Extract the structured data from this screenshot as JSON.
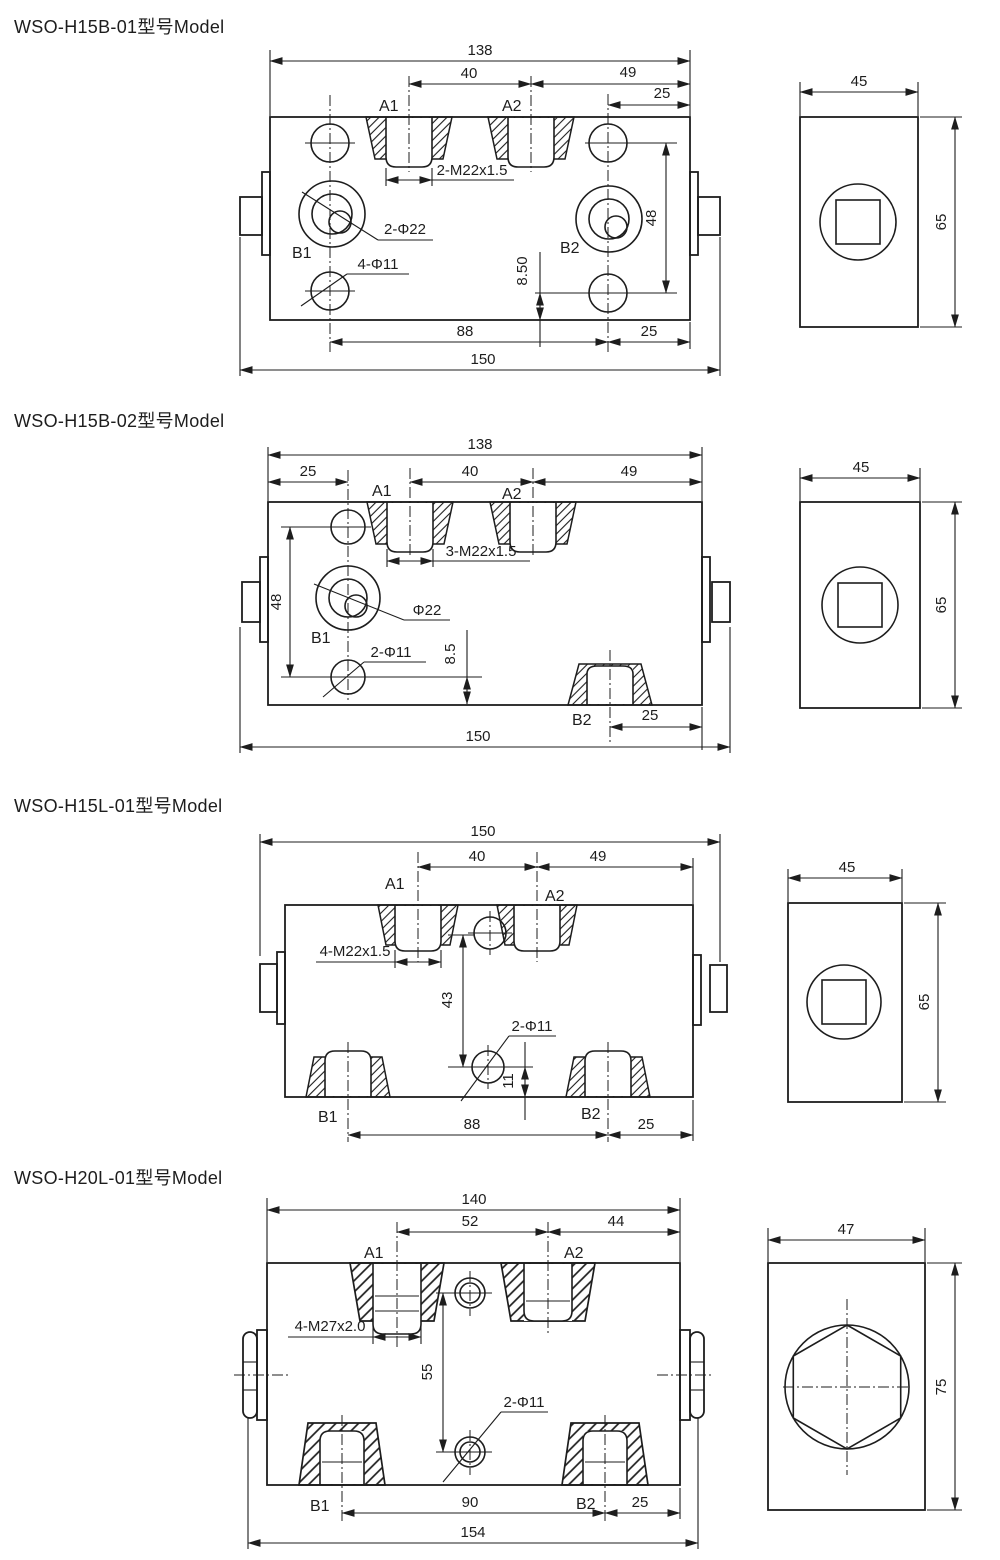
{
  "page": {
    "background": "#ffffff",
    "ink": "#1d1d1d"
  },
  "models": [
    {
      "title": "WSO-H15B-01型号Model",
      "front": {
        "ports": {
          "a1": "A1",
          "a2": "A2",
          "b1": "B1",
          "b2": "B2"
        },
        "ann": {
          "thread": "2-M22x1.5",
          "bore": "2-Φ22",
          "bolts": "4-Φ11"
        },
        "dims": {
          "top": "138",
          "span": "40",
          "right": "49",
          "offset": "25",
          "v": "48",
          "edge": "8.50",
          "bottom_span": "88",
          "bottom_right": "25",
          "overall": "150"
        }
      },
      "side": {
        "w": "45",
        "h": "65"
      }
    },
    {
      "title": "WSO-H15B-02型号Model",
      "front": {
        "ports": {
          "a1": "A1",
          "a2": "A2",
          "b1": "B1",
          "b2": "B2"
        },
        "ann": {
          "thread": "3-M22x1.5",
          "bore": "Φ22",
          "bolts": "2-Φ11"
        },
        "dims": {
          "top": "138",
          "left": "25",
          "span": "40",
          "right": "49",
          "v": "48",
          "edge": "8.5",
          "bottom_right": "25",
          "overall": "150"
        }
      },
      "side": {
        "w": "45",
        "h": "65"
      }
    },
    {
      "title": "WSO-H15L-01型号Model",
      "front": {
        "ports": {
          "a1": "A1",
          "a2": "A2",
          "b1": "B1",
          "b2": "B2"
        },
        "ann": {
          "thread": "4-M22x1.5",
          "holes": "2-Φ11"
        },
        "dims": {
          "top": "150",
          "span": "40",
          "right": "49",
          "v": "43",
          "edge": "11",
          "bottom_span": "88",
          "bottom_right": "25"
        }
      },
      "side": {
        "w": "45",
        "h": "65"
      }
    },
    {
      "title": "WSO-H20L-01型号Model",
      "front": {
        "ports": {
          "a1": "A1",
          "a2": "A2",
          "b1": "B1",
          "b2": "B2"
        },
        "ann": {
          "thread": "4-M27x2.0",
          "holes": "2-Φ11"
        },
        "dims": {
          "top": "140",
          "span": "52",
          "right": "44",
          "v": "55",
          "bottom_span": "90",
          "bottom_right": "25",
          "overall": "154"
        }
      },
      "side": {
        "w": "47",
        "h": "75"
      }
    }
  ]
}
